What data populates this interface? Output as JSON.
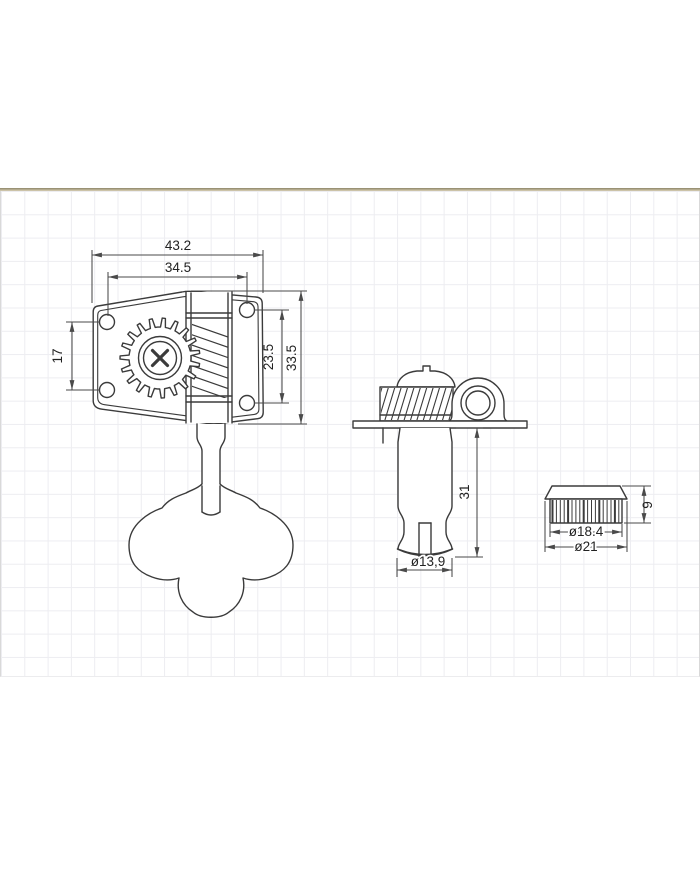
{
  "front_view": {
    "overall_width": "43.2",
    "hole_span_width": "34.5",
    "left_hole_spacing": "17",
    "right_hole_spacing": "23.5",
    "overall_height": "33.5"
  },
  "side_view": {
    "post_length": "31",
    "post_diameter": "ø13,9"
  },
  "bushing_view": {
    "barrel_diameter": "ø18.4",
    "flange_diameter": "ø21",
    "height": "9"
  },
  "colors": {
    "line": "#3b3b3b",
    "dimension": "#4a4a4a",
    "text": "#222222",
    "grid_line": "#ededf1",
    "top_rule": "#8e8568",
    "paper": "#ffffff"
  }
}
